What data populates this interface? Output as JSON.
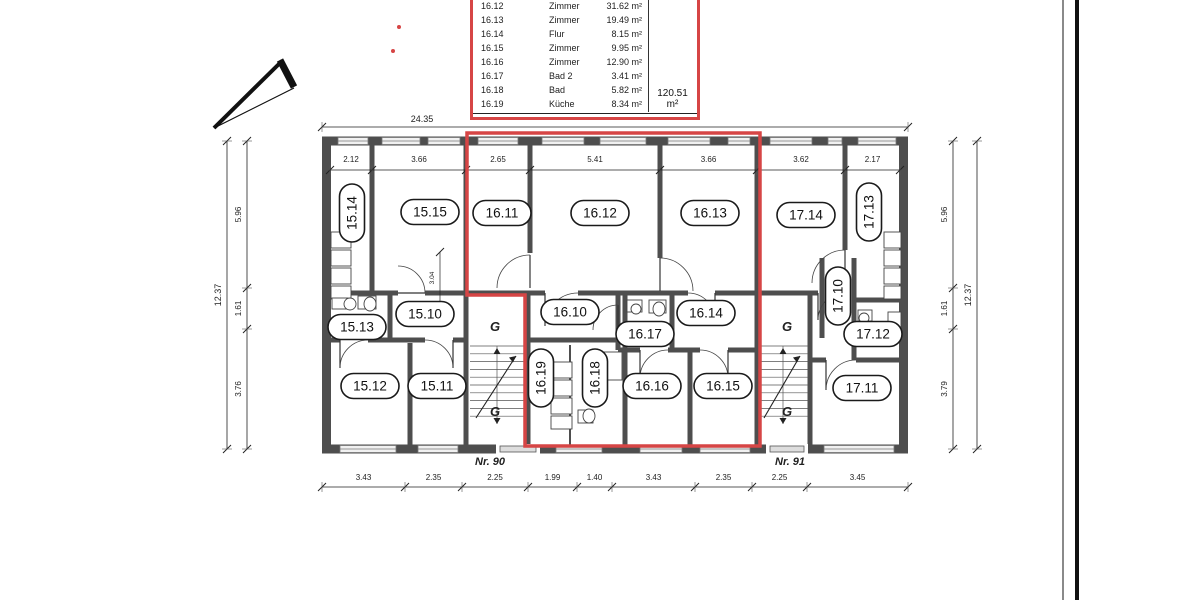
{
  "colors": {
    "red": "#d64545",
    "wall": "#4e4e4e",
    "line": "#2b2b2b",
    "thin": "#333333"
  },
  "area_table": {
    "rows": [
      {
        "id": "16.12",
        "name": "Zimmer",
        "area": "31.62 m²"
      },
      {
        "id": "16.13",
        "name": "Zimmer",
        "area": "19.49 m²"
      },
      {
        "id": "16.14",
        "name": "Flur",
        "area": "8.15 m²"
      },
      {
        "id": "16.15",
        "name": "Zimmer",
        "area": "9.95 m²"
      },
      {
        "id": "16.16",
        "name": "Zimmer",
        "area": "12.90 m²"
      },
      {
        "id": "16.17",
        "name": "Bad 2",
        "area": "3.41 m²"
      },
      {
        "id": "16.18",
        "name": "Bad",
        "area": "5.82 m²"
      },
      {
        "id": "16.19",
        "name": "Küche",
        "area": "8.34 m²"
      }
    ],
    "total": "120.51 m²"
  },
  "plan": {
    "room_labels": [
      {
        "text": "15.14",
        "x": 352,
        "y": 213,
        "v": 1
      },
      {
        "text": "15.15",
        "x": 430,
        "y": 212
      },
      {
        "text": "16.11",
        "x": 502,
        "y": 213
      },
      {
        "text": "16.12",
        "x": 600,
        "y": 213
      },
      {
        "text": "16.13",
        "x": 710,
        "y": 213
      },
      {
        "text": "17.14",
        "x": 806,
        "y": 215
      },
      {
        "text": "17.13",
        "x": 869,
        "y": 212,
        "v": 1
      },
      {
        "text": "15.13",
        "x": 357,
        "y": 327
      },
      {
        "text": "15.10",
        "x": 425,
        "y": 314
      },
      {
        "text": "16.10",
        "x": 570,
        "y": 312
      },
      {
        "text": "16.17",
        "x": 645,
        "y": 334
      },
      {
        "text": "16.14",
        "x": 706,
        "y": 313
      },
      {
        "text": "17.10",
        "x": 838,
        "y": 296,
        "v": 1
      },
      {
        "text": "17.12",
        "x": 873,
        "y": 334
      },
      {
        "text": "15.12",
        "x": 370,
        "y": 386
      },
      {
        "text": "15.11",
        "x": 437,
        "y": 386
      },
      {
        "text": "16.19",
        "x": 541,
        "y": 378,
        "v": 1
      },
      {
        "text": "16.18",
        "x": 595,
        "y": 378,
        "v": 1
      },
      {
        "text": "16.16",
        "x": 652,
        "y": 386
      },
      {
        "text": "16.15",
        "x": 723,
        "y": 386
      },
      {
        "text": "17.11",
        "x": 862,
        "y": 388
      }
    ],
    "stair_hall_labels": [
      {
        "text": "G",
        "x": 495,
        "y": 331
      },
      {
        "text": "G",
        "x": 495,
        "y": 416
      },
      {
        "text": "G",
        "x": 787,
        "y": 331
      },
      {
        "text": "G",
        "x": 787,
        "y": 416
      }
    ],
    "entrance_labels": [
      {
        "text": "Nr. 90",
        "x": 490,
        "y": 465
      },
      {
        "text": "Nr. 91",
        "x": 790,
        "y": 465
      }
    ],
    "dimensions": {
      "top_overall": "24.35",
      "top_rooms": [
        "2.12",
        "3.66",
        "2.65",
        "5.41",
        "3.66",
        "3.62",
        "2.17"
      ],
      "bottom": [
        "3.43",
        "2.35",
        "2.25",
        "1.99",
        "1.40",
        "3.43",
        "2.35",
        "2.25",
        "3.45"
      ],
      "left_overall": "12.37",
      "left_chain": [
        "5.96",
        "1.61",
        "3.76"
      ],
      "right_overall": "12.37",
      "right_chain": [
        "5.96",
        "1.61",
        "3.79"
      ],
      "inner": "3.04"
    },
    "icons": [
      "north-arrow-icon"
    ]
  }
}
